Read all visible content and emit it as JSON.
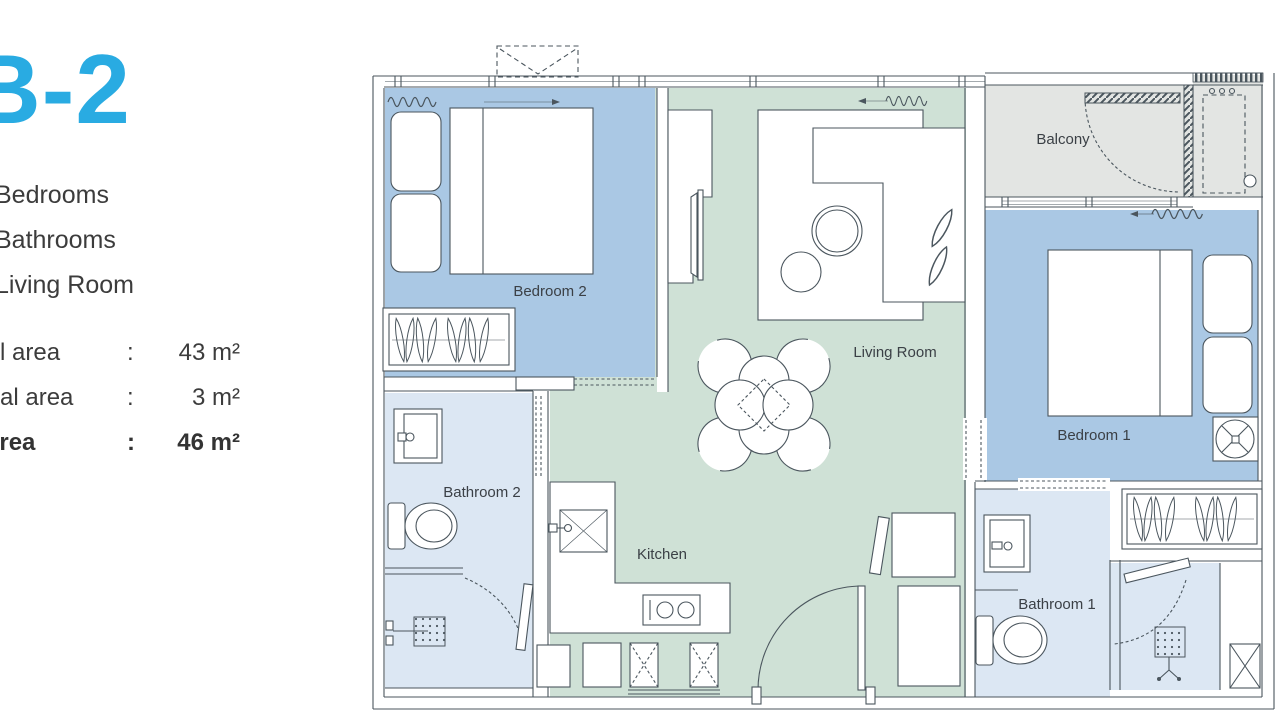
{
  "sidebar": {
    "accent_color": "#29abe2",
    "unit_title": "B-2",
    "features": [
      "Bedrooms",
      "Bathrooms",
      "Living Room"
    ],
    "areas": [
      {
        "label": "l area",
        "colon": ":",
        "value": "43 m²"
      },
      {
        "label": "al area",
        "colon": ":",
        "value": "3 m²"
      },
      {
        "label": "area",
        "colon": ":",
        "value": "46 m²"
      }
    ]
  },
  "plan": {
    "labels": {
      "bedroom2": "Bedroom 2",
      "living_room": "Living Room",
      "balcony": "Balcony",
      "bedroom1": "Bedroom 1",
      "bathroom1": "Bathroom 1",
      "bathroom2": "Bathroom 2",
      "kitchen": "Kitchen"
    },
    "colors": {
      "bedroom_fill": "#aac8e4",
      "living_fill": "#cfe1d6",
      "balcony_fill": "#e3e5e3",
      "bathroom_fill": "#dce7f3",
      "line": "#4b565e",
      "label_text": "#3b4046"
    }
  }
}
